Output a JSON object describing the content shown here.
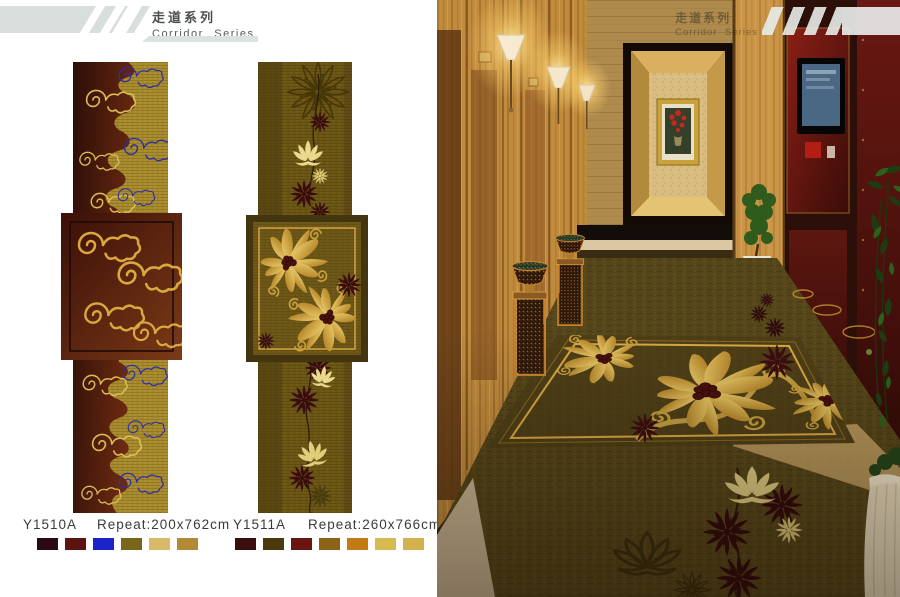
{
  "header": {
    "title_zh": "走道系列",
    "title_en": "Corridor Series"
  },
  "products": [
    {
      "code": "Y1510A",
      "repeat": "Repeat:200x762cm",
      "swatches": [
        "#2d0a12",
        "#5c1312",
        "#1b24c8",
        "#7a651c",
        "#d9b868",
        "#b18a33"
      ]
    },
    {
      "code": "Y1511A",
      "repeat": "Repeat:260x766cm",
      "swatches": [
        "#3a0d10",
        "#4a3a0e",
        "#6b1511",
        "#8a6414",
        "#c47b16",
        "#d6bb52",
        "#d2b14e"
      ]
    }
  ],
  "photo_overlay": {
    "title_zh": "走道系列",
    "title_en": "Corridor Series"
  },
  "palette": {
    "banner_gray": "#d7dedb",
    "runner1_gold_field": "#a5892d",
    "runner1_maroon": "#5a2410",
    "runner1_blue_cloud": "#2c2fa6",
    "runner2_olive_field": "#6b5616",
    "rug_border_gold": "#d9a943"
  }
}
